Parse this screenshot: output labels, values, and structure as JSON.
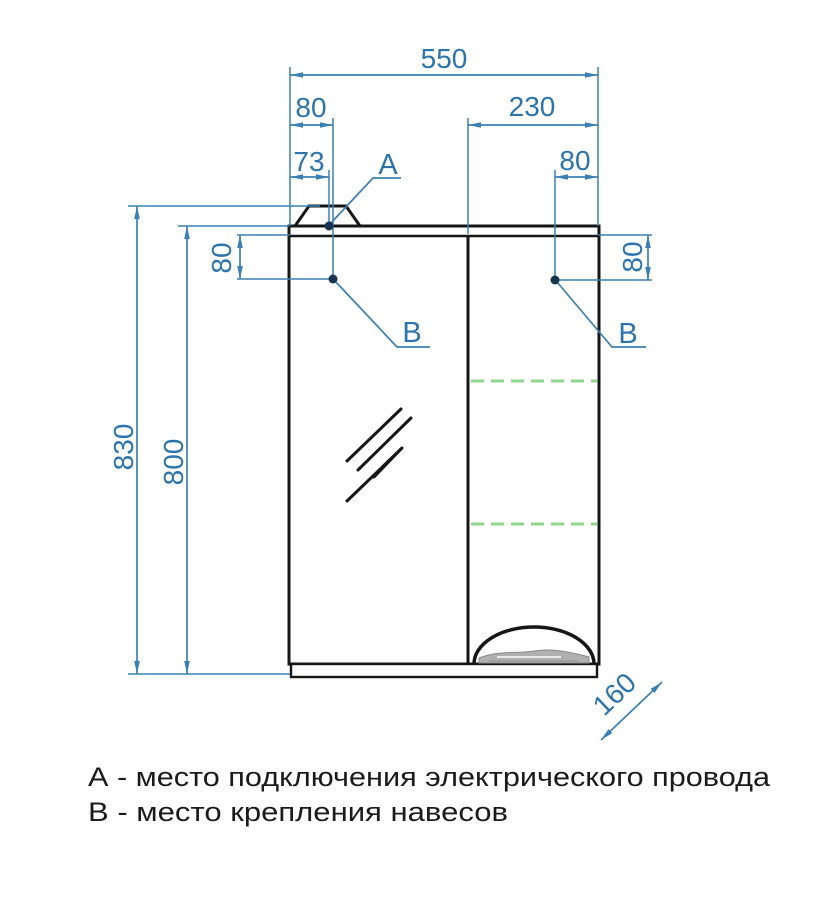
{
  "drawing_type": "furniture-technical-drawing",
  "dimensions": {
    "overall_width": "550",
    "top_left_offset": "80",
    "point_a_offset": "73",
    "right_door_width": "230",
    "top_right_offset": "80",
    "overall_height": "830",
    "cabinet_height": "800",
    "hinge_left_offset": "80",
    "hinge_right_offset": "80",
    "depth": "160"
  },
  "points": {
    "a": "А",
    "b_left": "В",
    "b_right": "В"
  },
  "legend": [
    "А - место подключения электрического провода",
    "В - место крепления навесов"
  ],
  "colors": {
    "dimension_blue": "#3a80b4",
    "dimension_text_blue": "#2c74ae",
    "outline_black": "#161616",
    "shelf_green": "#8fd78f",
    "marker_dot_navy": "#18354f",
    "legend_text": "#1b1b1b",
    "background": "#ffffff",
    "basket_gray": "#b0b0b0"
  }
}
